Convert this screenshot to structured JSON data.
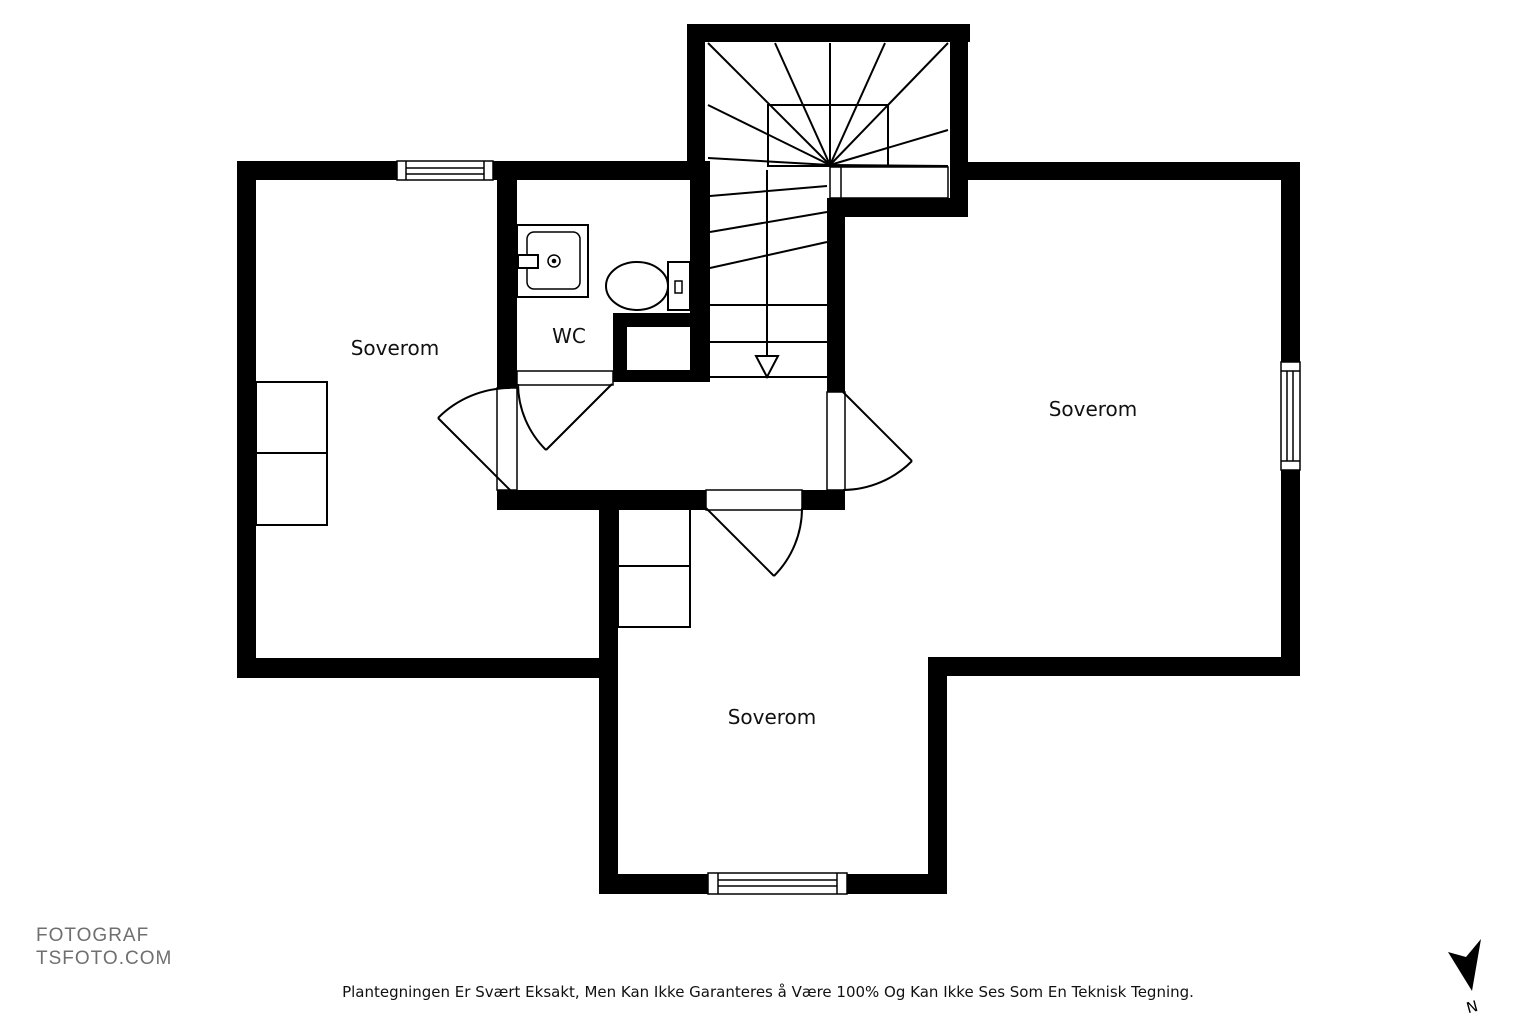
{
  "document_type": "floor-plan",
  "rooms": [
    {
      "id": "bedroom-left",
      "label": "Soverom"
    },
    {
      "id": "wc",
      "label": "WC"
    },
    {
      "id": "bedroom-right",
      "label": "Soverom"
    },
    {
      "id": "bedroom-bottom",
      "label": "Soverom"
    }
  ],
  "footer": {
    "photographer_line1": "FOTOGRAF",
    "photographer_line2": "TSFOTO.COM",
    "disclaimer": "Plantegningen Er Svært Eksakt, Men Kan Ikke Garanteres å Være 100% Og Kan Ikke Ses Som En Teknisk Tegning."
  },
  "compass": {
    "label": "N"
  },
  "colors": {
    "wall": "#000000",
    "background": "#ffffff",
    "line": "#000000",
    "footer_text": "#6f6f6f",
    "label_text": "#111111"
  }
}
